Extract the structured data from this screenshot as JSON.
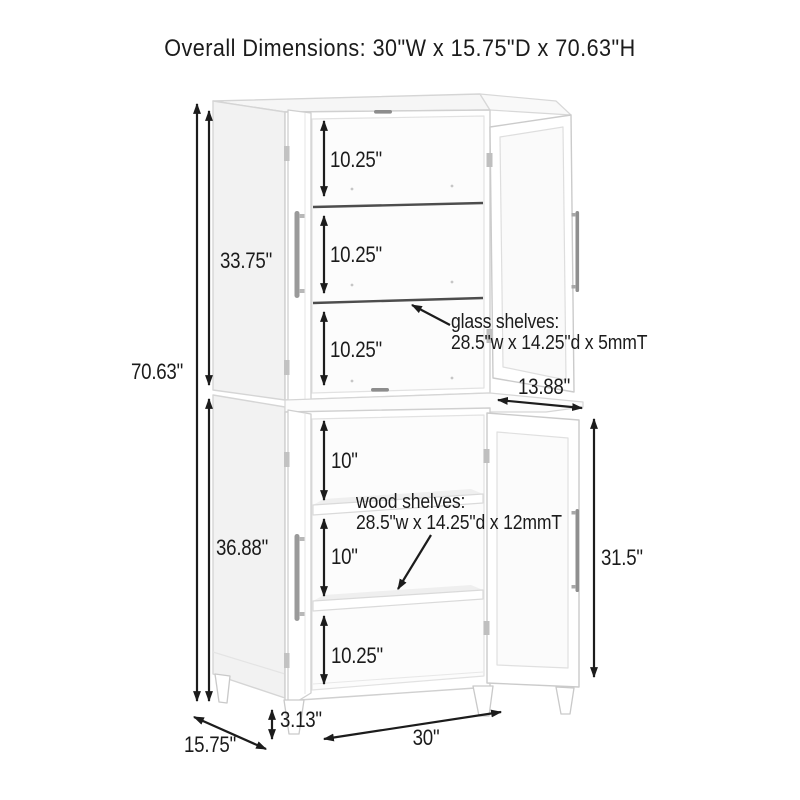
{
  "title": "Overall Dimensions: 30\"W x 15.75\"D x 70.63\"H",
  "dimensions": {
    "overall_height": "70.63\"",
    "upper_cabinet_height": "33.75\"",
    "lower_cabinet_height": "36.88\"",
    "upper_sections": [
      "10.25\"",
      "10.25\"",
      "10.25\""
    ],
    "lower_sections": [
      "10\"",
      "10\"",
      "10.25\""
    ],
    "upper_door_width": "13.88\"",
    "lower_door_height": "31.5\"",
    "leg_height": "3.13\"",
    "overall_width": "30\"",
    "overall_depth": "15.75\""
  },
  "notes": {
    "glass_shelves": {
      "label": "glass shelves:",
      "size": "28.5\"w x 14.25\"d x 5mmT"
    },
    "wood_shelves": {
      "label": "wood shelves:",
      "size": "28.5\"w x 14.25\"d x 12mmT"
    }
  },
  "colors": {
    "text": "#1b1b1b",
    "dimension_line": "#1c1c1c",
    "cabinet_outline": "#d2d2d2",
    "shelf_edge": "#4d4d4d",
    "background": "#ffffff"
  }
}
